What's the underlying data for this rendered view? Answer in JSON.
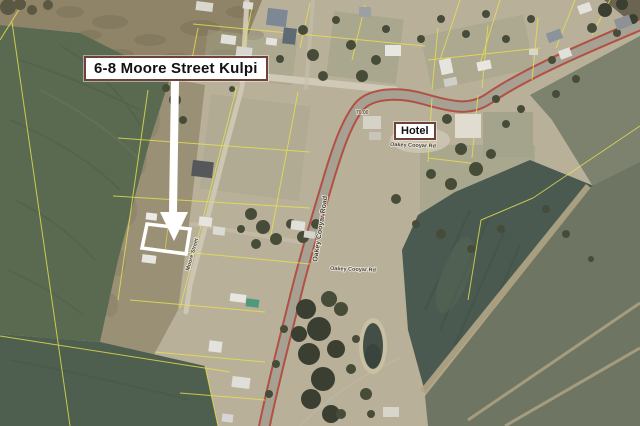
{
  "map": {
    "callout": {
      "text": "6-8 Moore Street Kulpi"
    },
    "hotel_label": {
      "text": "Hotel"
    },
    "road_labels": {
      "main_road_vertical": "Oakey Cooyar Road",
      "main_road_east": "Oakey Cooyar Rd",
      "main_road_south": "Oakey Cooyar Rd",
      "property_street": "Moore Street"
    },
    "spot_height": "70.00",
    "colors": {
      "town_gravel": "#b9b09a",
      "scrub_brown": "#8f8468",
      "field_green": "#5a6a50",
      "field_green_lower": "#4e5f4f",
      "field_teal": "#4a5a50",
      "field_grey_green": "#6e7663",
      "cadastre_yellow": "#e8e24e",
      "road_surface": "#a7a193",
      "road_edge_red": "#b0493d",
      "annotation_background": "#ffffff",
      "annotation_border": "#6e4238",
      "highlight_outline": "#ffffff"
    }
  }
}
